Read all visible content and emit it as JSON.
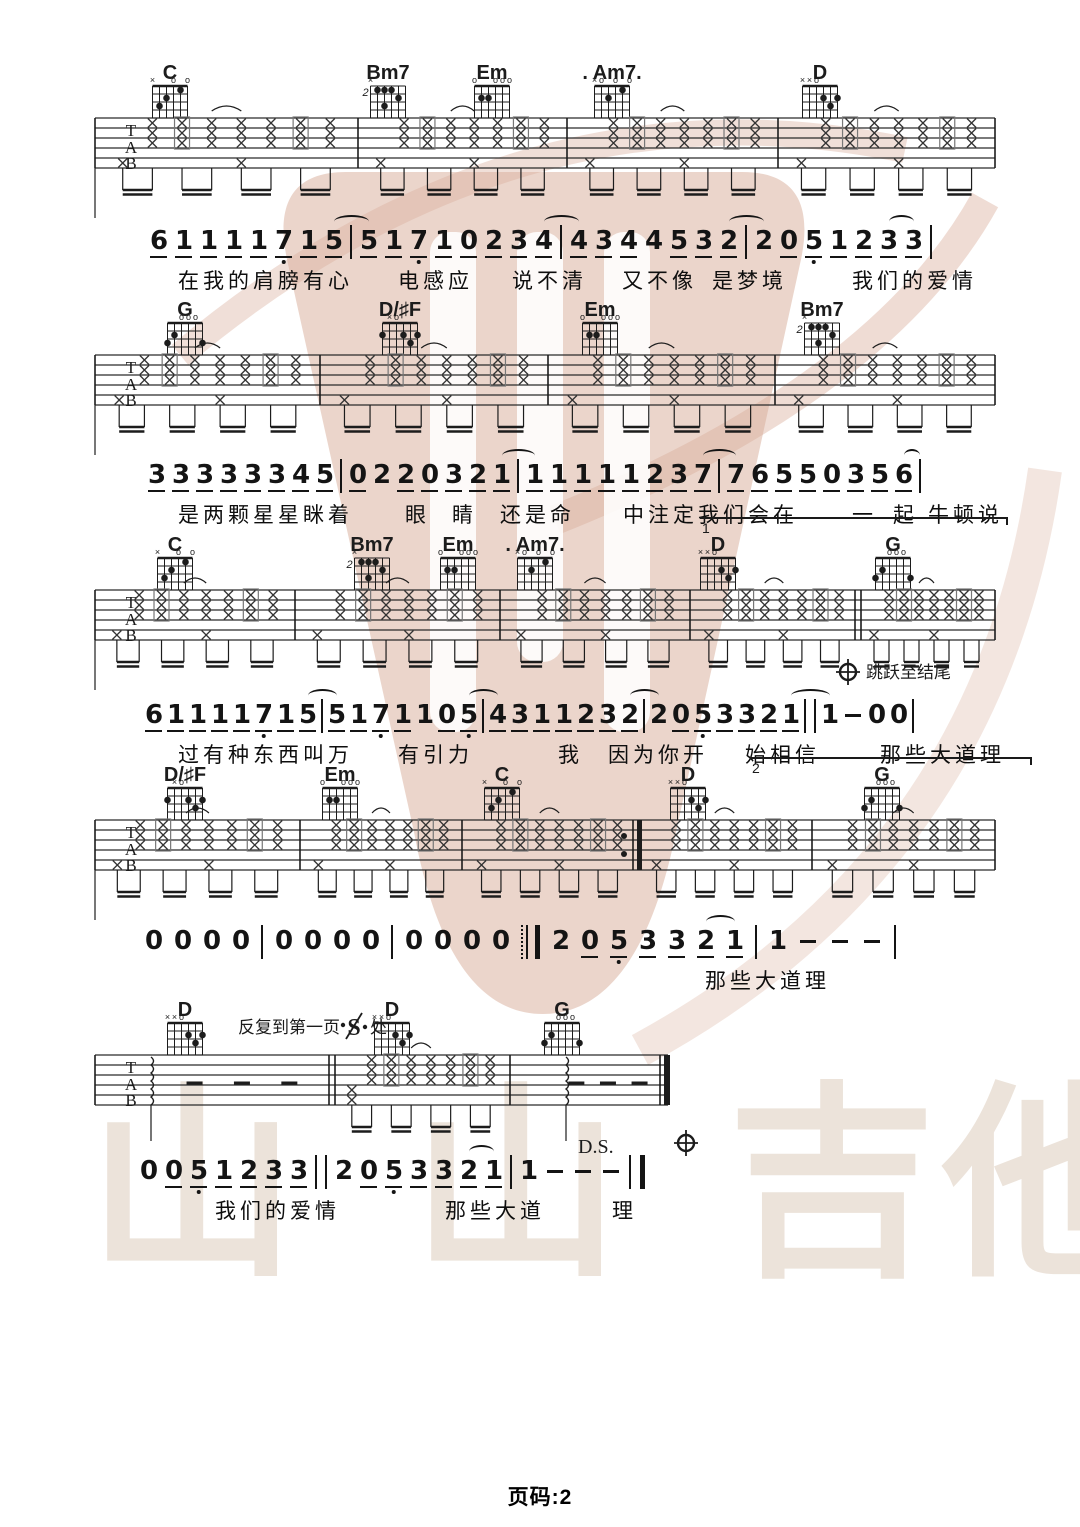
{
  "page": {
    "footer": "页码:2"
  },
  "watermark": {
    "brand_chars": [
      "山",
      "山",
      "吉",
      "他"
    ],
    "brand_x": [
      88,
      412,
      728,
      942
    ],
    "brand_y": 1082,
    "logo_color": "#d8ab98",
    "text_color": "#ece3da"
  },
  "clef_letters": [
    "T",
    "A",
    "B"
  ],
  "chord_shapes": {
    "C": {
      "top": [
        [
          "×",
          0
        ],
        [
          "o",
          3
        ],
        [
          "o",
          5
        ]
      ],
      "dots": [
        [
          1,
          3
        ],
        [
          2,
          2
        ],
        [
          4,
          1
        ]
      ]
    },
    "Bm7": {
      "fl": "2",
      "top": [
        [
          "×",
          0
        ]
      ],
      "dots": [
        [
          1,
          1
        ],
        [
          2,
          1
        ],
        [
          3,
          1
        ],
        [
          4,
          2
        ],
        [
          2,
          3
        ]
      ]
    },
    "Em": {
      "top": [
        [
          "o",
          0
        ],
        [
          "o",
          3
        ],
        [
          "o",
          4
        ],
        [
          "o",
          5
        ]
      ],
      "dots": [
        [
          1,
          2
        ],
        [
          2,
          2
        ]
      ]
    },
    "Am7": {
      "top": [
        [
          "×",
          0
        ],
        [
          "o",
          1
        ],
        [
          "o",
          3
        ],
        [
          "o",
          5
        ]
      ],
      "dots": [
        [
          2,
          2
        ],
        [
          4,
          1
        ]
      ]
    },
    "D": {
      "top": [
        [
          "×",
          0
        ],
        [
          "×",
          1
        ],
        [
          "o",
          2
        ]
      ],
      "dots": [
        [
          3,
          2
        ],
        [
          5,
          2
        ],
        [
          4,
          3
        ]
      ]
    },
    "G": {
      "top": [
        [
          "o",
          2
        ],
        [
          "o",
          3
        ],
        [
          "o",
          4
        ]
      ],
      "dots": [
        [
          0,
          3
        ],
        [
          1,
          2
        ],
        [
          5,
          3
        ]
      ]
    },
    "DsF": {
      "top": [
        [
          "×",
          1
        ],
        [
          "o",
          2
        ]
      ],
      "dots": [
        [
          0,
          2
        ],
        [
          3,
          2
        ],
        [
          5,
          2
        ],
        [
          4,
          3
        ]
      ]
    }
  },
  "systems": [
    {
      "y": 118,
      "x1": 95,
      "x2": 995,
      "drop": true,
      "chords": [
        {
          "x": 170,
          "label": "C",
          "shape": "C"
        },
        {
          "x": 388,
          "label": "Bm7",
          "shape": "Bm7"
        },
        {
          "x": 492,
          "label": "Em",
          "shape": "Em"
        },
        {
          "x": 612,
          "label": ". Am7.",
          "shape": "Am7"
        },
        {
          "x": 820,
          "label": "D",
          "shape": "D"
        }
      ],
      "bars": [
        {
          "x": 95,
          "t": "s"
        },
        {
          "x": 358,
          "t": "s"
        },
        {
          "x": 567,
          "t": "s"
        },
        {
          "x": 778,
          "t": "s"
        },
        {
          "x": 995,
          "t": "s"
        }
      ],
      "measures": [
        "std",
        "std",
        "std",
        "std"
      ]
    },
    {
      "y": 355,
      "x1": 95,
      "x2": 995,
      "drop": true,
      "chords": [
        {
          "x": 185,
          "label": "G",
          "shape": "G"
        },
        {
          "x": 400,
          "label": "D/♯F",
          "shape": "DsF"
        },
        {
          "x": 600,
          "label": "Em",
          "shape": "Em"
        },
        {
          "x": 822,
          "label": "Bm7",
          "shape": "Bm7"
        }
      ],
      "bars": [
        {
          "x": 95,
          "t": "s"
        },
        {
          "x": 320,
          "t": "s"
        },
        {
          "x": 548,
          "t": "s"
        },
        {
          "x": 775,
          "t": "s"
        },
        {
          "x": 995,
          "t": "s"
        }
      ],
      "measures": [
        "std",
        "std",
        "std",
        "std"
      ]
    },
    {
      "y": 590,
      "x1": 95,
      "x2": 995,
      "drop": true,
      "chords": [
        {
          "x": 175,
          "label": "C",
          "shape": "C"
        },
        {
          "x": 372,
          "label": "Bm7",
          "shape": "Bm7"
        },
        {
          "x": 458,
          "label": "Em",
          "shape": "Em"
        },
        {
          "x": 535,
          "label": ". Am7.",
          "shape": "Am7"
        },
        {
          "x": 718,
          "label": "D",
          "shape": "D"
        },
        {
          "x": 893,
          "label": "G",
          "shape": "G"
        }
      ],
      "bars": [
        {
          "x": 95,
          "t": "s"
        },
        {
          "x": 295,
          "t": "s"
        },
        {
          "x": 500,
          "t": "s"
        },
        {
          "x": 690,
          "t": "s"
        },
        {
          "x": 858,
          "t": "tt"
        },
        {
          "x": 995,
          "t": "s"
        }
      ],
      "measures": [
        "std",
        "std",
        "std",
        "std",
        "std"
      ],
      "coda_jump": {
        "x": 848,
        "label": "跳跃至结尾"
      }
    },
    {
      "y": 820,
      "x1": 95,
      "x2": 995,
      "drop": true,
      "chords": [
        {
          "x": 185,
          "label": "D/♯F",
          "shape": "DsF"
        },
        {
          "x": 340,
          "label": "Em",
          "shape": "Em"
        },
        {
          "x": 502,
          "label": "C",
          "shape": "C"
        },
        {
          "x": 688,
          "label": "D",
          "shape": "D"
        },
        {
          "x": 882,
          "label": "G",
          "shape": "G"
        }
      ],
      "bars": [
        {
          "x": 95,
          "t": "s"
        },
        {
          "x": 300,
          "t": "s"
        },
        {
          "x": 462,
          "t": "s"
        },
        {
          "x": 637,
          "t": "er"
        },
        {
          "x": 812,
          "t": "s"
        },
        {
          "x": 995,
          "t": "s"
        }
      ],
      "measures": [
        "std",
        "std",
        "std",
        "std",
        "std"
      ]
    },
    {
      "y": 1055,
      "x1": 95,
      "x2": 668,
      "drop": false,
      "chords": [
        {
          "x": 185,
          "label": "D",
          "shape": "D"
        },
        {
          "x": 392,
          "label": "D",
          "shape": "D"
        },
        {
          "x": 562,
          "label": "G",
          "shape": "G"
        }
      ],
      "bars": [
        {
          "x": 95,
          "t": "s"
        },
        {
          "x": 332,
          "t": "tt"
        },
        {
          "x": 510,
          "t": "s"
        },
        {
          "x": 668,
          "t": "final"
        }
      ],
      "measures": [
        "arp",
        "str7",
        "arp"
      ],
      "repeat_text": {
        "x": 238,
        "pre": "反复到第一页",
        "post": "处"
      },
      "ds_text": {
        "x": 578,
        "t": "D.S."
      },
      "coda_below": {
        "x": 686
      }
    }
  ],
  "jianpu": [
    {
      "y": 228,
      "x": 150,
      "gap": 8,
      "tokens": [
        "6u",
        "1u",
        "1u",
        "1u",
        "1u",
        "7u.",
        "1u",
        "5u(",
        "|",
        "5u)",
        "1u",
        "7u.",
        "1u",
        "0u",
        "2u",
        "3u",
        "4u(",
        "|",
        "4u)",
        "3u",
        "4u",
        "4",
        "5u",
        "3u",
        "2u(",
        "|",
        "2)",
        "0u",
        "5u.",
        "1u",
        "2u",
        "3u(",
        "3u)",
        "|"
      ],
      "lyrics": [
        {
          "x": 178,
          "t": "在我的肩膀有心"
        },
        {
          "x": 398,
          "t": "电感应"
        },
        {
          "x": 512,
          "t": "说不清"
        },
        {
          "x": 622,
          "t": "又不像"
        },
        {
          "x": 712,
          "t": "是梦境"
        },
        {
          "x": 852,
          "t": "我们的爱情"
        }
      ]
    },
    {
      "y": 462,
      "x": 148,
      "gap": 7,
      "tokens": [
        "3u",
        "3u",
        "3u",
        "3u",
        "3u",
        "3u",
        "4u",
        "5u",
        "|",
        "0u",
        "2",
        "2u",
        "0u",
        "3u",
        "2u",
        "1u(",
        "|",
        "1u)",
        "1u",
        "1u",
        "1u",
        "1u",
        "2u",
        "3u",
        "7u(",
        "|",
        "7u)",
        "6u",
        "5u",
        "5u",
        "0u",
        "3u",
        "5u",
        "6u(",
        "|)"
      ],
      "lyrics": [
        {
          "x": 178,
          "t": "是两颗星星眯着"
        },
        {
          "x": 405,
          "t": "眼"
        },
        {
          "x": 452,
          "t": "睛"
        },
        {
          "x": 500,
          "t": "还是命"
        },
        {
          "x": 623,
          "t": "中注定我们会在"
        },
        {
          "x": 852,
          "t": "一"
        },
        {
          "x": 893,
          "t": "起"
        },
        {
          "x": 928,
          "t": "牛顿说"
        }
      ]
    },
    {
      "y": 702,
      "x": 145,
      "gap": 5,
      "tokens": [
        "6u",
        "1u",
        "1u",
        "1u",
        "1u",
        "7u.",
        "1u",
        "5u(",
        "|",
        "5u)",
        "1u",
        "7u.",
        "1u",
        "1",
        "0u",
        "5u.(",
        "|",
        "4u)",
        "3u",
        "1u",
        "1u",
        "2u",
        "3u",
        "2u(",
        "|",
        "2)",
        "0u",
        "5u.",
        "3u",
        "3u",
        "2u",
        "1u(",
        "‖",
        "1)",
        "-",
        "0",
        "0",
        "|"
      ],
      "lyrics": [
        {
          "x": 178,
          "t": "过有种东西叫万"
        },
        {
          "x": 398,
          "t": "有引力"
        },
        {
          "x": 558,
          "t": "我"
        },
        {
          "x": 608,
          "t": "因为你开"
        },
        {
          "x": 745,
          "t": "始相信"
        },
        {
          "x": 880,
          "t": "那些大道理"
        }
      ]
    },
    {
      "y": 928,
      "x": 145,
      "gap": 12,
      "tokens": [
        "0",
        "0",
        "0",
        "0",
        "|",
        "0",
        "0",
        "0",
        "0",
        "|",
        "0",
        "0",
        "0",
        "0",
        ":‖",
        "2",
        "0u",
        "5u.",
        "3u",
        "3u",
        "2u(",
        "1u)",
        "|",
        "1",
        "-",
        "-",
        "-",
        "|"
      ],
      "lyrics": [
        {
          "x": 705,
          "t": "那些大道理"
        }
      ]
    },
    {
      "y": 1158,
      "x": 140,
      "gap": 8,
      "tokens": [
        "0",
        "0u",
        "5u.",
        "1u",
        "2u",
        "3u",
        "3u",
        "‖",
        "2",
        "0u",
        "5u.",
        "3u",
        "3u",
        "2u(",
        "1u)",
        "|",
        "1",
        "-",
        "-",
        "-",
        "‖f"
      ],
      "lyrics": [
        {
          "x": 215,
          "t": "我们的爱情"
        },
        {
          "x": 445,
          "t": "那些大道"
        },
        {
          "x": 612,
          "t": "理"
        }
      ]
    }
  ],
  "voltas": [
    {
      "x1": 700,
      "x2": 1008,
      "y": 517,
      "label": "1"
    },
    {
      "x1": 750,
      "x2": 1032,
      "y": 757,
      "label": "2"
    }
  ]
}
